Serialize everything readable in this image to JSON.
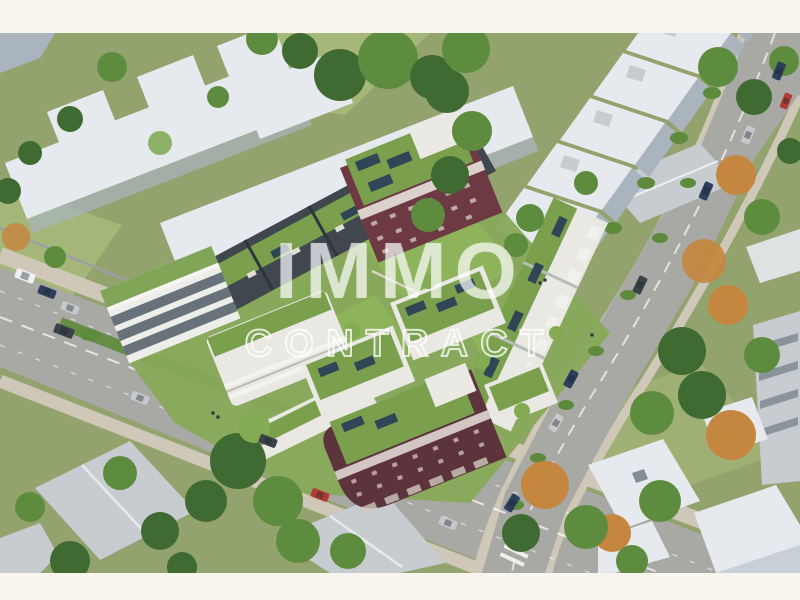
{
  "watermark": {
    "line1": "IMMO",
    "line2": "CONTRACT"
  },
  "scene": {
    "description": "Aerial 3D architectural rendering of a new residential city block with planted green roofs, rooftop terraces and solar panels, two brick-red corner buildings, a central lawn courtyard, surrounded by streets with cars, gray existing buildings, a row of gabled houses, suburban homes and trees"
  },
  "colors": {
    "frame": "#f8f5ee",
    "grass": "#93a36e",
    "courtyard": "#87a95a",
    "lawn": "#a9bb7c",
    "lawnbright": "#8db35b",
    "greenroof": "#7aa04e",
    "hedge": "#5e8a3c",
    "road": "#a8a8a4",
    "sidewalk": "#cfc8b8",
    "roadline": "#ffffff",
    "bldgwhite": "#e6eaee",
    "bldgshade": "#aab4be",
    "bldgray": "#c7ccd1",
    "windowdark": "#5a6570",
    "slate": "#40474f",
    "facade": "#e9e8e2",
    "brick": "#6d3a43",
    "brickdark": "#5d333c",
    "solar": "#2e4656",
    "treedark": "#3f6a31",
    "treemid": "#5d8c3f",
    "treelight": "#82ab54",
    "treeautumn": "#c5873f",
    "carblue": "#2d3f5c",
    "carsilver": "#c6c9cc",
    "carred": "#b23b34",
    "cardark": "#3b4248",
    "carwhite": "#eef0f1",
    "wmfill": "rgba(255,255,255,0.55)",
    "wmfill2": "rgba(255,255,255,0.08)",
    "wmstroke": "rgba(255,255,255,0.82)"
  }
}
